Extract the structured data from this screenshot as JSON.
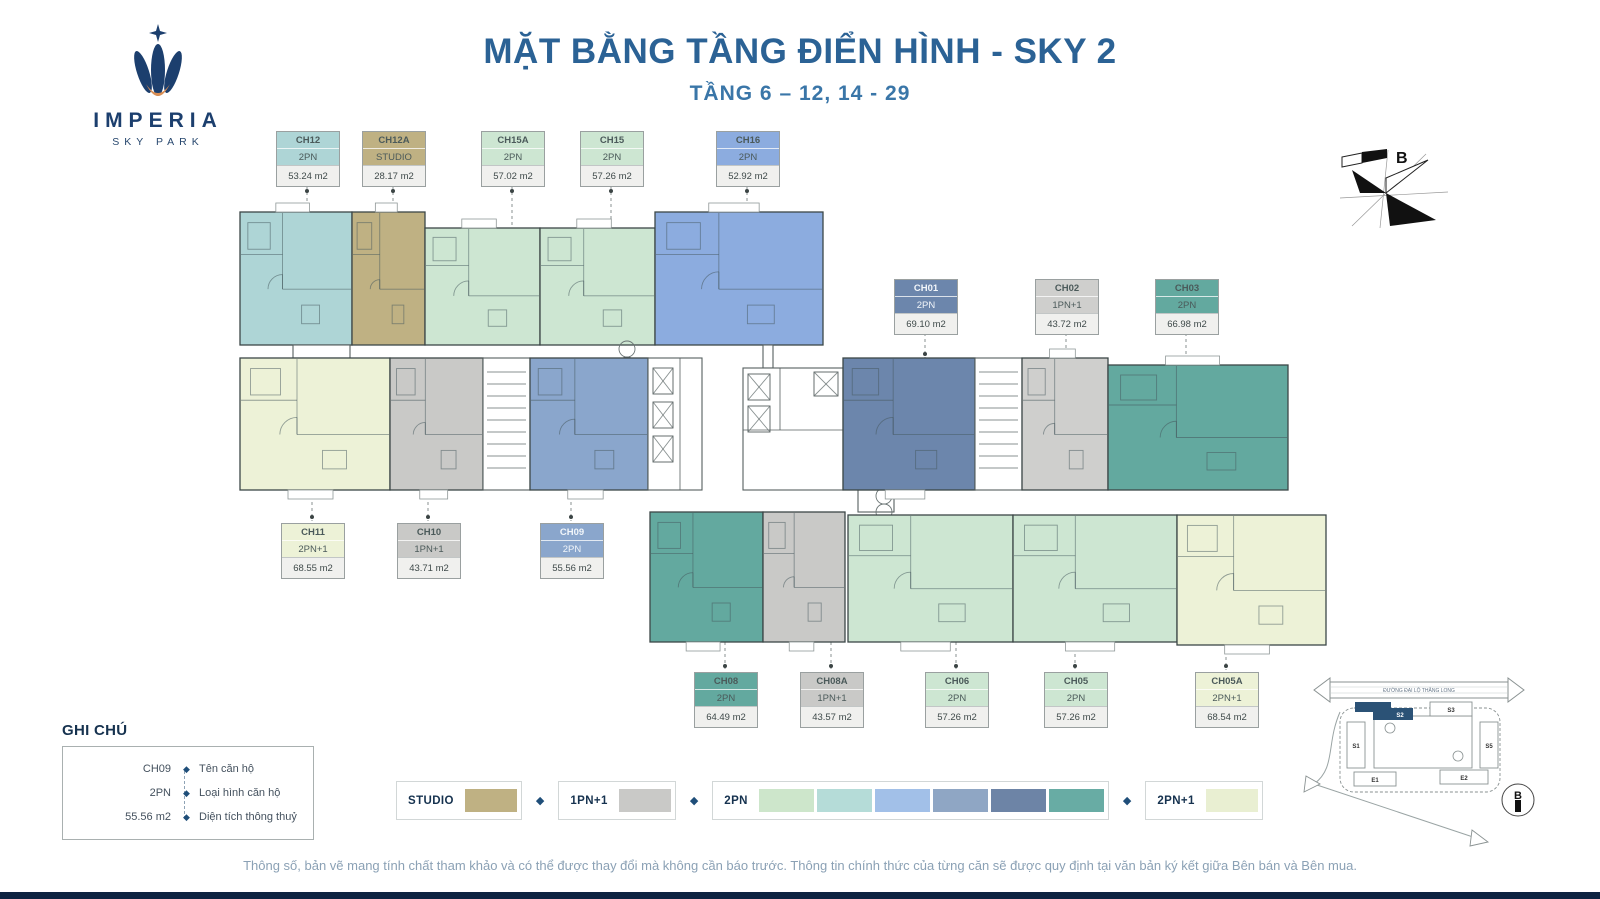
{
  "header": {
    "title": "MẶT BẰNG TẦNG ĐIỂN HÌNH - SKY 2",
    "subtitle": "TẦNG 6 – 12, 14 - 29"
  },
  "logo": {
    "brand": "IMPERIA",
    "tagline": "SKY PARK"
  },
  "compass": {
    "label": "B"
  },
  "units": {
    "CH12": {
      "code": "CH12",
      "type": "2PN",
      "area": "53.24 m2",
      "color": "#aed5d6"
    },
    "CH12A": {
      "code": "CH12A",
      "type": "STUDIO",
      "area": "28.17 m2",
      "color": "#bfb183"
    },
    "CH15A": {
      "code": "CH15A",
      "type": "2PN",
      "area": "57.02 m2",
      "color": "#cde6d2"
    },
    "CH15": {
      "code": "CH15",
      "type": "2PN",
      "area": "57.26 m2",
      "color": "#cde6d2"
    },
    "CH16": {
      "code": "CH16",
      "type": "2PN",
      "area": "52.92 m2",
      "color": "#8cacdf"
    },
    "CH01": {
      "code": "CH01",
      "type": "2PN",
      "area": "69.10 m2",
      "color": "#6c86ac"
    },
    "CH02": {
      "code": "CH02",
      "type": "1PN+1",
      "area": "43.72 m2",
      "color": "#cfcfcd"
    },
    "CH03": {
      "code": "CH03",
      "type": "2PN",
      "area": "66.98 m2",
      "color": "#63a99f"
    },
    "CH11": {
      "code": "CH11",
      "type": "2PN+1",
      "area": "68.55 m2",
      "color": "#edf2d7"
    },
    "CH10": {
      "code": "CH10",
      "type": "1PN+1",
      "area": "43.71 m2",
      "color": "#c9c9c7"
    },
    "CH09": {
      "code": "CH09",
      "type": "2PN",
      "area": "55.56 m2",
      "color": "#8aa6cc"
    },
    "CH08": {
      "code": "CH08",
      "type": "2PN",
      "area": "64.49 m2",
      "color": "#63a99f"
    },
    "CH08A": {
      "code": "CH08A",
      "type": "1PN+1",
      "area": "43.57 m2",
      "color": "#c9c9c7"
    },
    "CH06": {
      "code": "CH06",
      "type": "2PN",
      "area": "57.26 m2",
      "color": "#cde6d2"
    },
    "CH05": {
      "code": "CH05",
      "type": "2PN",
      "area": "57.26 m2",
      "color": "#cde6d2"
    },
    "CH05A": {
      "code": "CH05A",
      "type": "2PN+1",
      "area": "68.54 m2",
      "color": "#edf2d7"
    }
  },
  "note_legend": {
    "title": "GHI CHÚ",
    "rows": [
      {
        "sample": "CH09",
        "desc": "Tên căn hộ"
      },
      {
        "sample": "2PN",
        "desc": "Loại hình căn hộ"
      },
      {
        "sample": "55.56 m2",
        "desc": "Diện tích thông thuỷ"
      }
    ]
  },
  "type_legend": {
    "items": [
      {
        "label": "STUDIO",
        "swatches": [
          "#bfb183"
        ]
      },
      {
        "label": "1PN+1",
        "swatches": [
          "#c9c9c7"
        ]
      },
      {
        "label": "2PN",
        "swatches": [
          "#cde6cb",
          "#b5dcd8",
          "#a2c0e8",
          "#8fa6c4",
          "#6d84a6",
          "#68aca4"
        ]
      },
      {
        "label": "2PN+1",
        "swatches": [
          "#e9efd2"
        ]
      }
    ]
  },
  "sitemap": {
    "road": "ĐƯỜNG ĐẠI LỘ THĂNG LONG",
    "buildings": {
      "s1": "S1",
      "s2": "S2",
      "s3": "S3",
      "s5": "S5",
      "e1": "E1",
      "e2": "E2"
    },
    "highlighted": "S2",
    "compass_label": "B"
  },
  "footer": {
    "disclaimer": "Thông số, bản vẽ mang tính chất tham khảo và có thể được thay đổi mà không cần báo trước. Thông tin chính thức của từng căn sẽ được quy định tại văn bản ký kết giữa Bên bán và Bên mua."
  }
}
